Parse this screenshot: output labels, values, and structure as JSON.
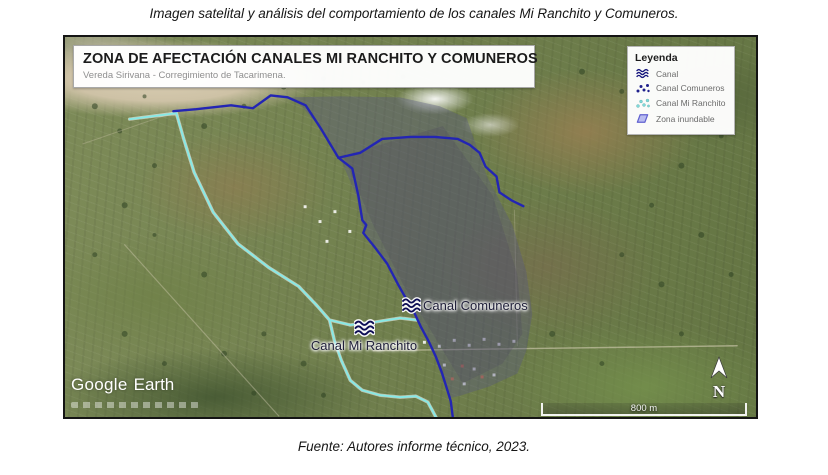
{
  "figure": {
    "title": "Imagen satelital y análisis del comportamiento de los canales Mi Ranchito y Comuneros.",
    "caption": "Fuente: Autores informe técnico, 2023."
  },
  "map": {
    "header": {
      "title": "ZONA DE AFECTACIÓN CANALES MI RANCHITO Y COMUNEROS",
      "subtitle": "Vereda Sirivana - Corregimiento de Tacarimena."
    },
    "legend": {
      "title": "Leyenda",
      "items": [
        {
          "label": "Canal",
          "icon": "canal-wave-icon"
        },
        {
          "label": "Canal Comuneros",
          "icon": "dotted-path-icon-navy"
        },
        {
          "label": "Canal Mi Ranchito",
          "icon": "dotted-path-icon-cyan"
        },
        {
          "label": "Zona inundable",
          "icon": "flood-polygon-icon"
        }
      ]
    },
    "annotations": {
      "canal_comuneros": "Canal Comuneros",
      "canal_mi_ranchito": "Canal Mi Ranchito"
    },
    "scale_bar": {
      "label": "800 m"
    },
    "north_label": "N",
    "watermark": {
      "google": "Google",
      "earth": "Earth"
    }
  },
  "colors": {
    "canal_navy": "#2325b4",
    "canal_cyan": "#86e9e6",
    "flood_zone_fill": "#56568033",
    "legend_polygon_fill": "#b9bcf0",
    "legend_polygon_stroke": "#6262d0"
  }
}
